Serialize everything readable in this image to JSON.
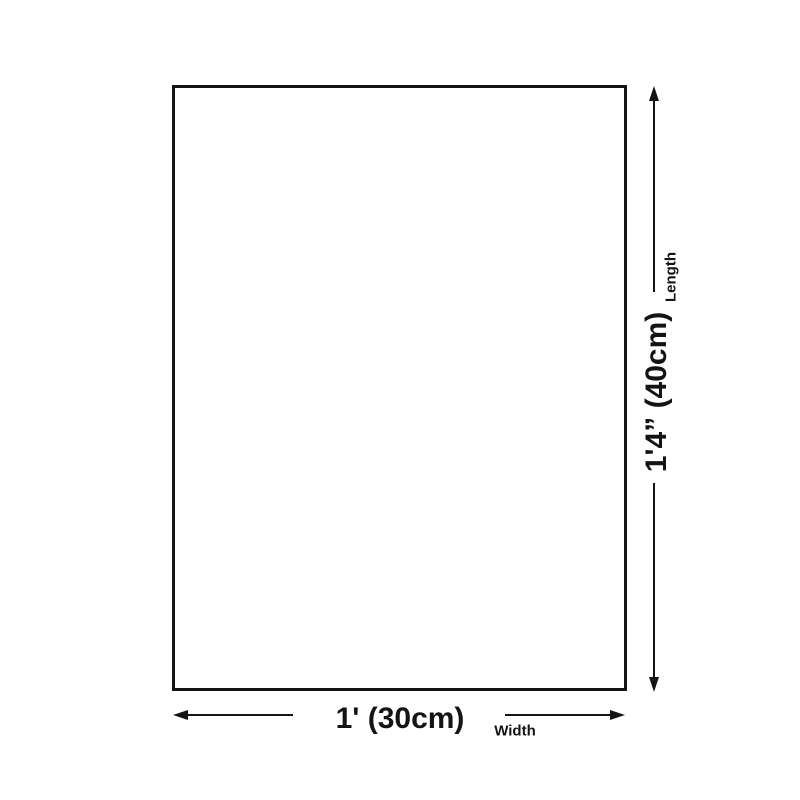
{
  "diagram": {
    "length": {
      "value": "1'4” (40cm)",
      "label": "Length"
    },
    "width": {
      "value": "1' (30cm)",
      "label": "Width"
    },
    "colors": {
      "ink": "#141414",
      "background": "#ffffff"
    }
  }
}
